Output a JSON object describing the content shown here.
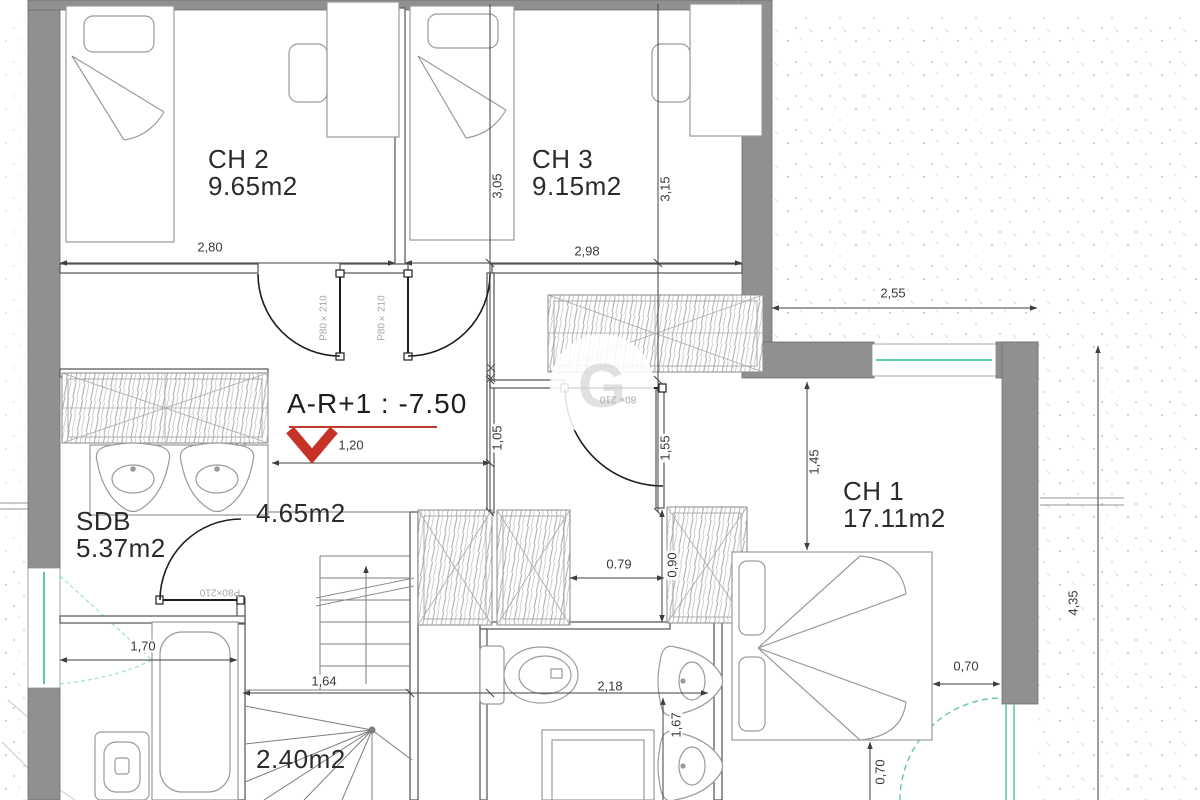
{
  "colors": {
    "wall_gray": "#909090",
    "line_dark": "#1e1e1e",
    "dim_gray": "#383838",
    "accent_red": "#c0392b",
    "window_teal": "#5fc9ae"
  },
  "level_marker": {
    "label": "A-R+1 : -7.50"
  },
  "rooms": {
    "ch2": {
      "name": "CH 2",
      "area": "9.65m2"
    },
    "ch3": {
      "name": "CH 3",
      "area": "9.15m2"
    },
    "ch1": {
      "name": "CH 1",
      "area": "17.11m2"
    },
    "sdb": {
      "name": "SDB",
      "area": "5.37m2"
    },
    "hallway": {
      "area": "4.65m2"
    },
    "stairwell": {
      "area": "2.40m2"
    }
  },
  "dimensions": {
    "ch2_width": "2,80",
    "ch3_width": "2,98",
    "terrace_width": "2,55",
    "ch2_depth": "3,05",
    "ch3_depth": "3,15",
    "hall_width": "1,20",
    "hall_seg_left": "1,05",
    "hall_seg_right": "1,55",
    "ch1_entry_depth": "1,45",
    "closet_gap": "0.79",
    "closet_depth": "0,90",
    "sdb_clear": "1,70",
    "stair_width": "1,64",
    "wc_width": "2,18",
    "wc_depth": "1,67",
    "bed_to_wall": "0,70",
    "bed_to_front": "0,70",
    "right_boundary": "4,35"
  },
  "door_labels": {
    "ch2_door": "P80×210",
    "ch3_door": "P80×210",
    "sdb_door": "P80×210",
    "ch1_door": "80× 210"
  },
  "watermark": {
    "letter": "G"
  }
}
